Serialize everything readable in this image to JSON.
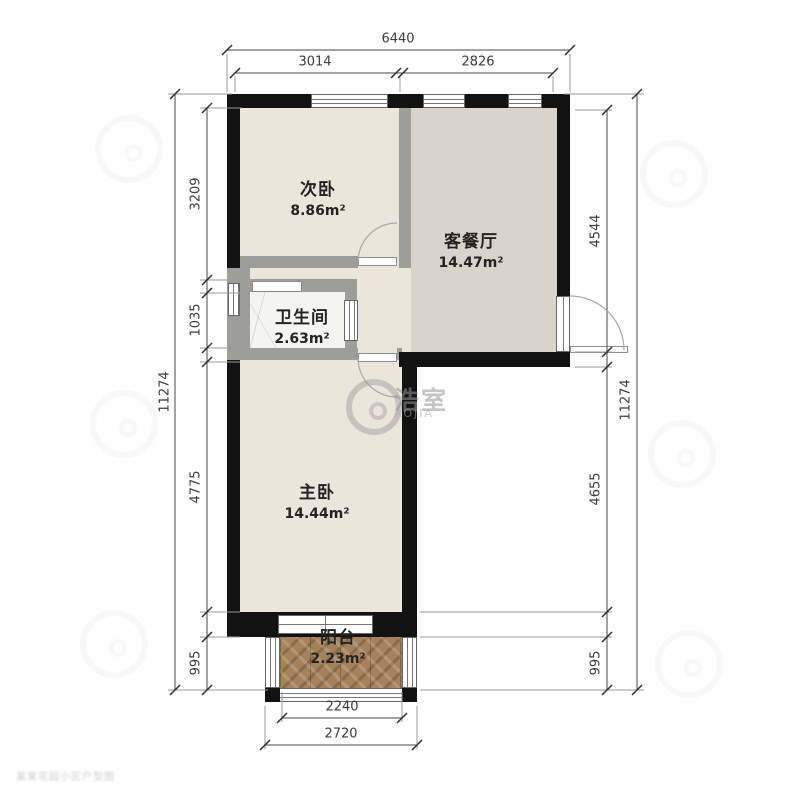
{
  "rooms": {
    "secondary_bedroom": {
      "name": "次卧",
      "area": "8.86m²"
    },
    "living_dining": {
      "name": "客餐厅",
      "area": "14.47m²"
    },
    "bathroom": {
      "name": "卫生间",
      "area": "2.63m²"
    },
    "master_bedroom": {
      "name": "主卧",
      "area": "14.44m²"
    },
    "balcony": {
      "name": "阳台",
      "area": "2.23m²"
    }
  },
  "dims": {
    "top_total": "6440",
    "top_a": "3014",
    "top_b": "2826",
    "left_total": "11274",
    "left_a": "3209",
    "left_b": "1035",
    "left_c": "4775",
    "left_d": "995",
    "right_total": "11274",
    "right_a": "4544",
    "right_b": "4655",
    "right_c": "995",
    "bottom_a": "2240",
    "bottom_b": "2720"
  },
  "watermark": {
    "brand_cn": "浩室",
    "brand_latin": "AOJIA",
    "corner_text": "某某花园小区户型图"
  },
  "colors": {
    "wall": "#121212",
    "partition": "#9d9d9b",
    "floor_bedroom": "#eae6db",
    "floor_living": "#d8d3cb",
    "floor_bath": "#f4f4f1",
    "floor_balcony": "#a5825c",
    "dim_text": "#3c3c3c"
  }
}
